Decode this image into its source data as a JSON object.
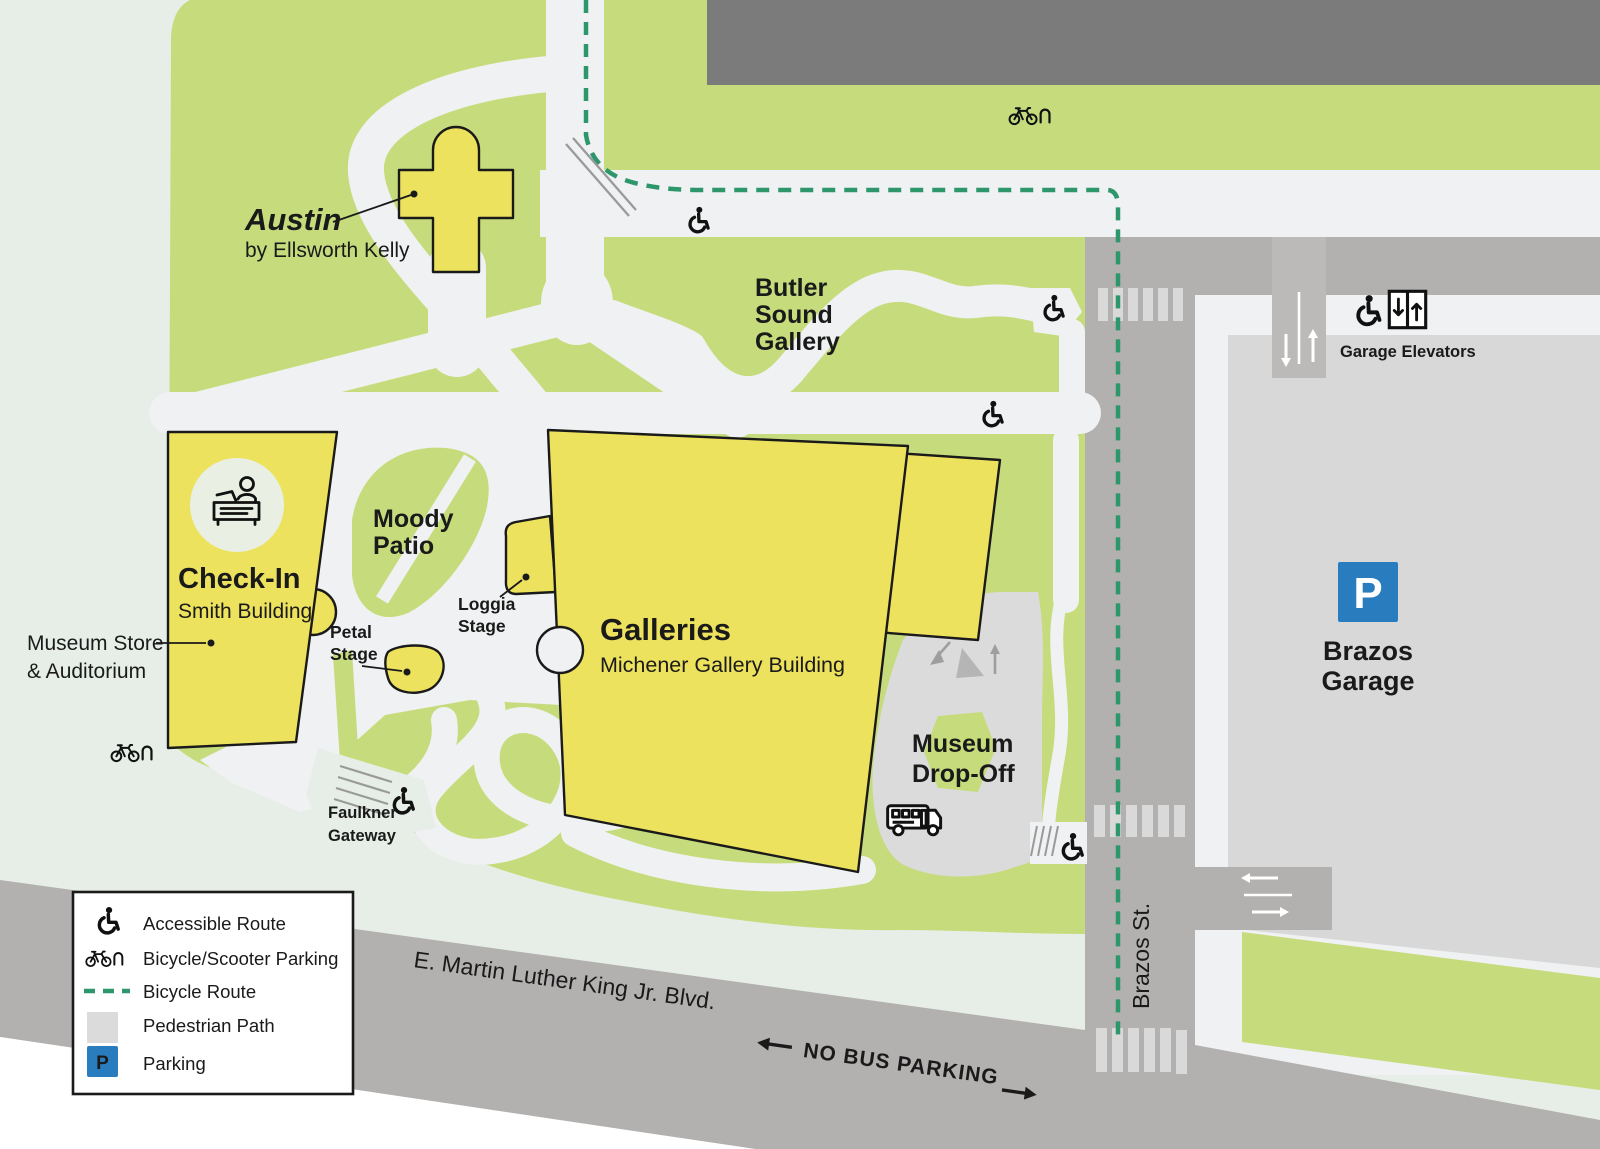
{
  "map": {
    "austin": {
      "title": "Austin",
      "subtitle": "by Ellsworth Kelly"
    },
    "butler_sound_gallery": {
      "line1": "Butler",
      "line2": "Sound",
      "line3": "Gallery"
    },
    "moody_patio": {
      "line1": "Moody",
      "line2": "Patio"
    },
    "check_in": {
      "title": "Check-In",
      "subtitle": "Smith Building"
    },
    "museum_store": {
      "line1": "Museum Store",
      "line2": "& Auditorium"
    },
    "loggia_stage": {
      "line1": "Loggia",
      "line2": "Stage"
    },
    "petal_stage": {
      "line1": "Petal",
      "line2": "Stage"
    },
    "galleries": {
      "title": "Galleries",
      "subtitle": "Michener Gallery Building"
    },
    "museum_drop_off": {
      "line1": "Museum",
      "line2": "Drop-Off"
    },
    "faulkner_gateway": {
      "line1": "Faulkner",
      "line2": "Gateway"
    },
    "brazos_garage": {
      "parking_symbol": "P",
      "line1": "Brazos",
      "line2": "Garage",
      "elevators_label": "Garage Elevators"
    },
    "streets": {
      "brazos": "Brazos St.",
      "mlk": "E. Martin Luther King Jr. Blvd.",
      "no_bus_parking": "NO BUS PARKING"
    }
  },
  "legend": {
    "parking_symbol": "P",
    "items": [
      {
        "icon": "wheelchair-icon",
        "label": "Accessible Route"
      },
      {
        "icon": "bicycle-icon",
        "label": "Bicycle/Scooter Parking"
      },
      {
        "icon": "dashed-line",
        "label": "Bicycle Route"
      },
      {
        "icon": "gray-square",
        "label": "Pedestrian Path"
      },
      {
        "icon": "parking-square",
        "label": "Parking"
      }
    ]
  },
  "colors": {
    "lawn": "#c6dc7c",
    "mint": "#e6eee7",
    "building_yellow": "#ede25e",
    "path_white": "#f0f1f2",
    "street_gray": "#b3b0b0",
    "ramp_gray": "#bcbab9",
    "dark_building": "#7b7b7b",
    "plaza_gray": "#dbdbdb",
    "garage_gray": "#d8d8d8",
    "bike_route": "#2d966b",
    "parking_blue": "#297dbe",
    "outline": "#1a1a1a"
  }
}
